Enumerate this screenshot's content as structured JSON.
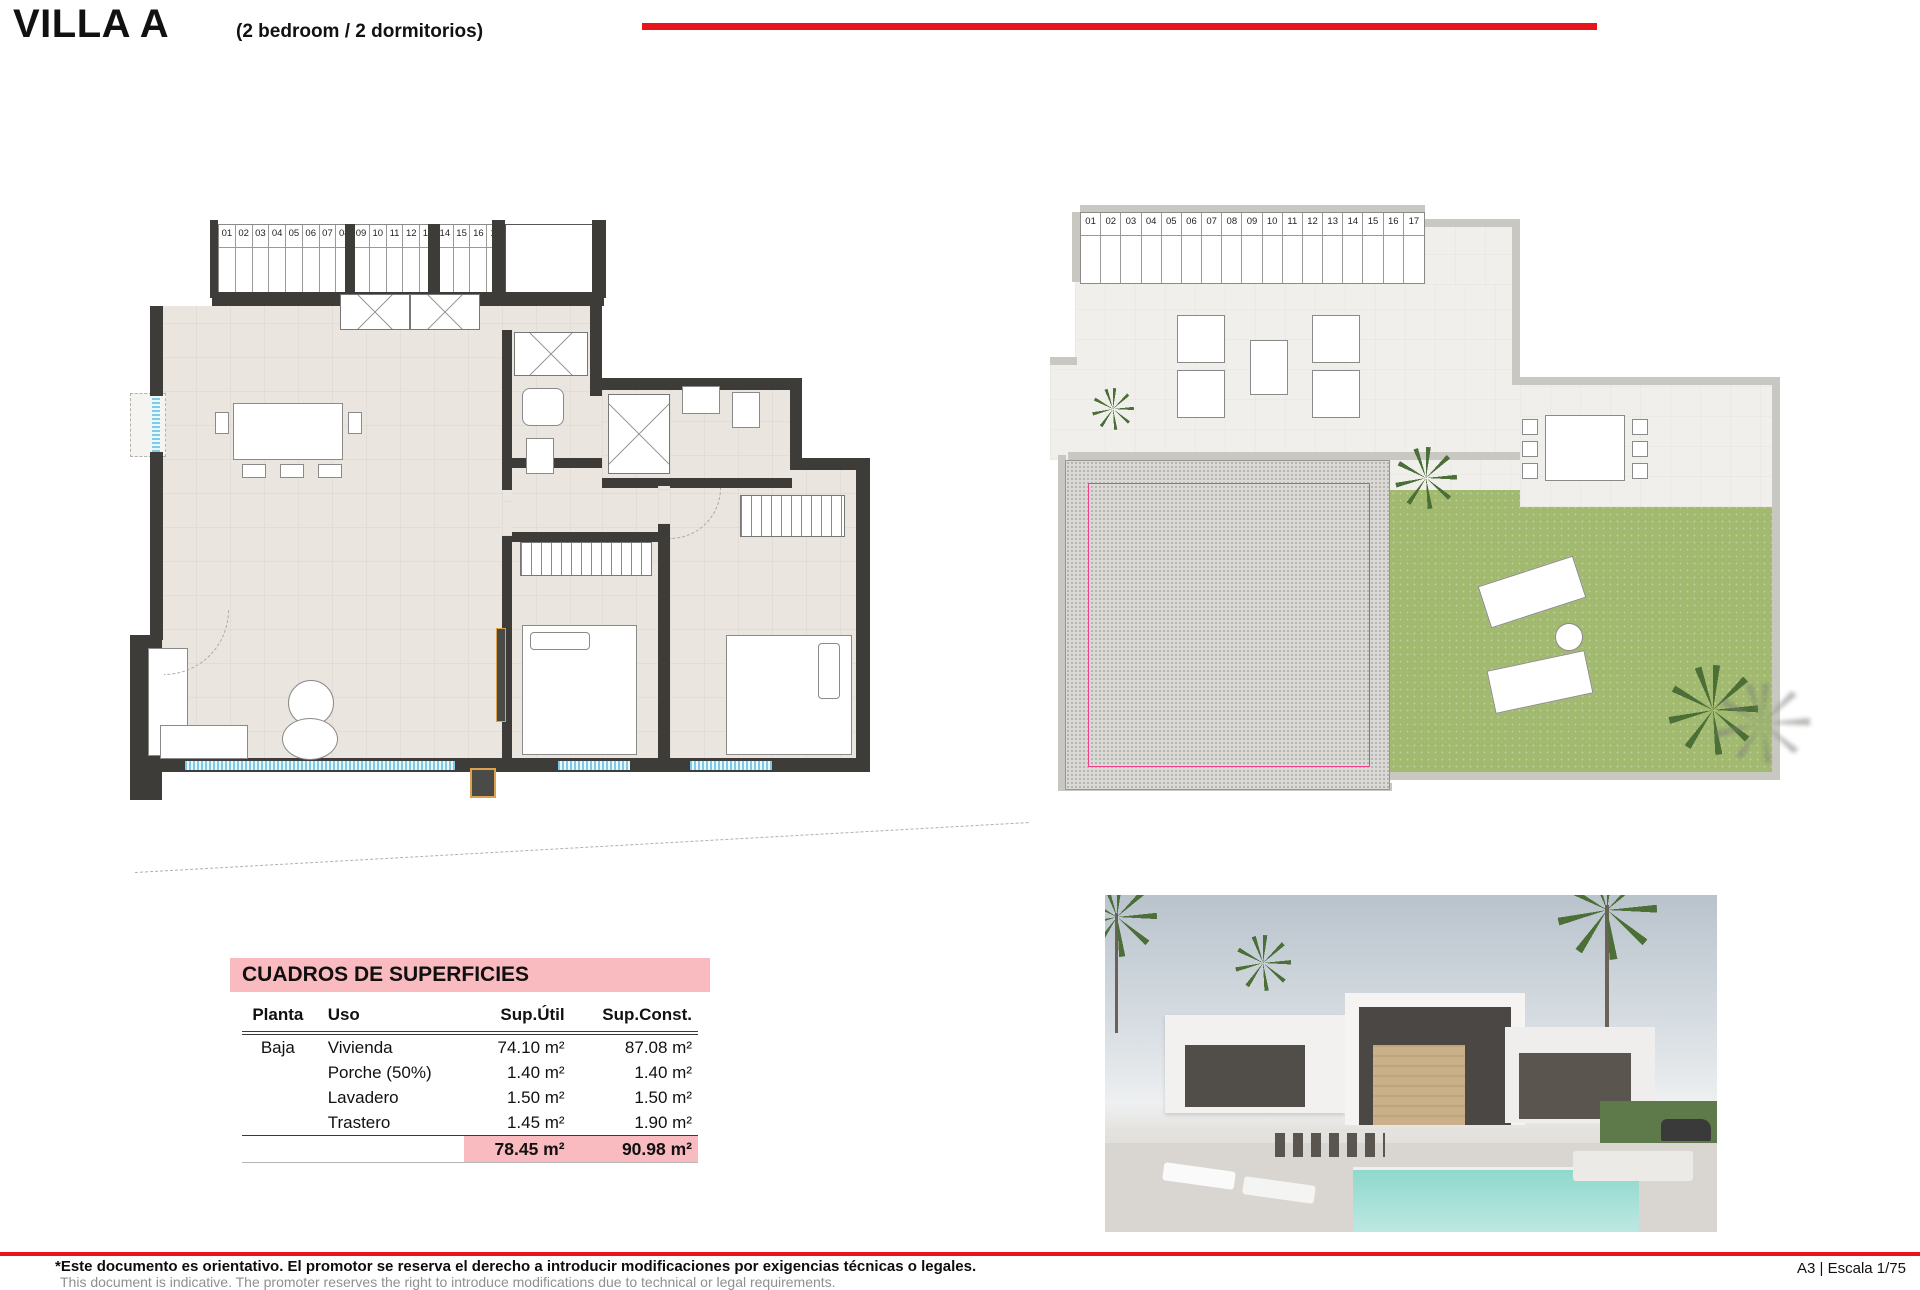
{
  "header": {
    "title": {
      "main": "VILLA A",
      "sub": "(2 bedroom / 2 dormitorios)"
    },
    "accent_red": "#e8131b"
  },
  "colors": {
    "dimension_pink": "#f0408c",
    "wall_dark": "#3d3c39",
    "floor_beige": "#eae6df",
    "grass_green": "#a2ba70",
    "table_pink": "#f9bac0",
    "window_blue": "#7ecbe8"
  },
  "plans": {
    "left": {
      "stairs": [
        "01",
        "02",
        "03",
        "04",
        "05",
        "06",
        "07",
        "08",
        "09",
        "10",
        "11",
        "12",
        "13",
        "14",
        "15",
        "16",
        "17"
      ],
      "rooms": [
        {
          "name": "PORCHE (50 %)",
          "sup": "Sup: 0.50 m2",
          "x": 363,
          "y": 6
        },
        {
          "name": "LAVADERO",
          "sup": "Sup: 1.50 m2",
          "x": 264,
          "y": 62
        },
        {
          "name": "TRASTERO",
          "sup": "Sup: 1.90 m2",
          "x": 420,
          "y": 48
        },
        {
          "name": "PORCHE (50 %)",
          "sup": "Sup: 0.90 m2",
          "x": 51,
          "y": 200
        },
        {
          "name": "SALÓN-COMEDOR-COCINA",
          "sup": "Sup: 38.25 m2",
          "x": 217,
          "y": 303
        },
        {
          "name": "BAÑO 2",
          "sup": "Sup: 4.15 m2",
          "x": 405,
          "y": 214
        },
        {
          "name": "BAÑO 1",
          "sup": "Sup: 4.05 m2",
          "x": 560,
          "y": 251
        },
        {
          "name": "PASO",
          "sup": "Sup: 2.70 m2",
          "x": 434,
          "y": 305
        },
        {
          "name": "DORMITORIO 3",
          "sup": "Sup: 11.00 m2",
          "x": 387,
          "y": 415
        },
        {
          "name": "DORMITORIO 1",
          "sup": "Sup: 13.95 m2",
          "x": 607,
          "y": 395
        }
      ],
      "dims": [
        {
          "t": "4.35",
          "x": 180,
          "y": 133,
          "o": "h",
          "len": 175
        },
        {
          "t": "1.40",
          "x": 414,
          "y": 133,
          "o": "h",
          "len": 62
        },
        {
          "t": "1.45",
          "x": 432,
          "y": 88,
          "o": "h",
          "len": 66
        },
        {
          "t": "1.10",
          "x": 462,
          "y": 66,
          "o": "v",
          "len": 42
        },
        {
          "t": "2.90",
          "x": 119,
          "y": 200,
          "o": "v",
          "len": 140
        },
        {
          "t": "2.65",
          "x": 326,
          "y": 195,
          "o": "v",
          "len": 240
        },
        {
          "t": "2.95",
          "x": 446,
          "y": 207,
          "o": "v",
          "len": 190
        },
        {
          "t": "2.90",
          "x": 575,
          "y": 222,
          "o": "h",
          "len": 95
        },
        {
          "t": "1.40",
          "x": 638,
          "y": 258,
          "o": "v",
          "len": 62
        },
        {
          "t": "1.50",
          "x": 73,
          "y": 238,
          "o": "v",
          "len": 52
        },
        {
          "t": "1.20",
          "x": 46,
          "y": 260,
          "o": "h",
          "len": 60
        },
        {
          "t": "0.90",
          "x": 474,
          "y": 331,
          "o": "none",
          "len": 0
        },
        {
          "t": "3.00",
          "x": 420,
          "y": 349,
          "o": "h",
          "len": 145
        },
        {
          "t": "4.95",
          "x": 49,
          "y": 396,
          "o": "v",
          "len": 255
        },
        {
          "t": "5.20",
          "x": 302,
          "y": 433,
          "o": "v",
          "len": 290
        },
        {
          "t": "4.80",
          "x": 560,
          "y": 447,
          "o": "v",
          "len": 270
        },
        {
          "t": "3.80",
          "x": 526,
          "y": 486,
          "o": "v",
          "len": 200
        },
        {
          "t": "5.20",
          "x": 178,
          "y": 589,
          "o": "h",
          "len": 280
        },
        {
          "t": "2.90",
          "x": 448,
          "y": 589,
          "o": "h",
          "len": 130
        },
        {
          "t": "2.90",
          "x": 632,
          "y": 589,
          "o": "h",
          "len": 130
        }
      ]
    },
    "right": {
      "stairs": [
        "01",
        "02",
        "03",
        "04",
        "05",
        "06",
        "07",
        "08",
        "09",
        "10",
        "11",
        "12",
        "13",
        "14",
        "15",
        "16",
        "17"
      ],
      "rooms": [
        {
          "name": "SOLARIUM",
          "sup": "Sup: 53.50 m2",
          "x": 378,
          "y": 286
        },
        {
          "name": "CUBIERTA NO TRANSITABLE",
          "sup": "Sup: 25.75 m2",
          "x": 175,
          "y": 438
        }
      ],
      "dims": [
        {
          "t": "1.67",
          "x": 392,
          "y": 38,
          "o": "h",
          "len": 100
        },
        {
          "t": "2.75",
          "x": 428,
          "y": 96,
          "o": "v",
          "len": 150
        },
        {
          "t": "4.28",
          "x": 208,
          "y": 98,
          "o": "h",
          "len": 285
        },
        {
          "t": "1.40",
          "x": 98,
          "y": 128,
          "o": "v",
          "len": 76
        },
        {
          "t": "2.70",
          "x": 322,
          "y": 168,
          "o": "v",
          "len": 150
        },
        {
          "t": "1.10",
          "x": 49,
          "y": 184,
          "o": "h",
          "len": 56
        },
        {
          "t": "1.30",
          "x": 26,
          "y": 208,
          "o": "v",
          "len": 46
        },
        {
          "t": "3.00",
          "x": 590,
          "y": 194,
          "o": "h",
          "len": 200
        },
        {
          "t": "1.50",
          "x": 650,
          "y": 234,
          "o": "v",
          "len": 48
        },
        {
          "t": "1.15",
          "x": 700,
          "y": 288,
          "o": "h",
          "len": 52
        },
        {
          "t": "5.05",
          "x": 333,
          "y": 423,
          "o": "v",
          "len": 290
        },
        {
          "t": "4.85",
          "x": 712,
          "y": 423,
          "o": "v",
          "len": 280
        },
        {
          "t": "5.10",
          "x": 172,
          "y": 552,
          "o": "h",
          "len": 300
        },
        {
          "t": "5.95",
          "x": 520,
          "y": 567,
          "o": "h",
          "len": 330
        }
      ]
    }
  },
  "table": {
    "title": "CUADROS DE SUPERFICIES",
    "columns": [
      "Planta",
      "Uso",
      "Sup.Útil",
      "Sup.Const."
    ],
    "rows": [
      [
        "Baja",
        "Vivienda",
        "74.10 m²",
        "87.08 m²"
      ],
      [
        "",
        "Porche (50%)",
        "1.40 m²",
        "1.40 m²"
      ],
      [
        "",
        "Lavadero",
        "1.50 m²",
        "1.50 m²"
      ],
      [
        "",
        "Trastero",
        "1.45 m²",
        "1.90 m²"
      ]
    ],
    "totals": [
      "",
      "",
      "78.45 m²",
      "90.98 m²"
    ]
  },
  "footer": {
    "disclaimer_es": "*Este documento es orientativo. El promotor se reserva el derecho a introducir modificaciones por exigencias técnicas o legales.",
    "disclaimer_en": "This document is indicative. The promoter reserves the right to introduce modifications due to technical or legal requirements.",
    "scale": "A3 | Escala 1/75"
  }
}
